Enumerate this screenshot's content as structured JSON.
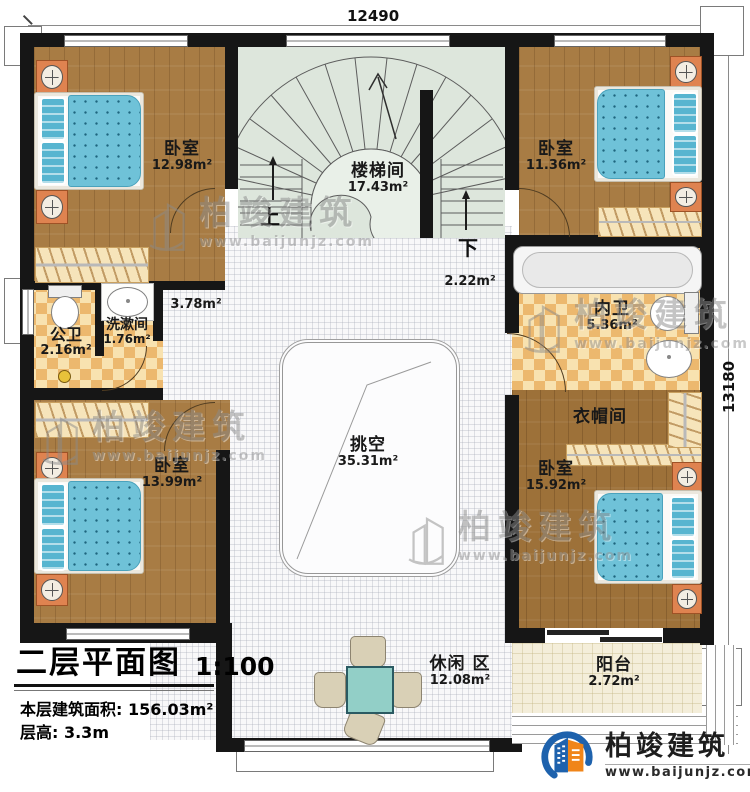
{
  "dimensions": {
    "width_label": "12490",
    "height_label": "13180"
  },
  "stairs": {
    "up": "上",
    "down": "下"
  },
  "rooms": {
    "bedroom_top_left": {
      "name": "卧室",
      "area": "12.98m²"
    },
    "stairwell": {
      "name": "楼梯间",
      "area": "17.43m²"
    },
    "bedroom_top_right": {
      "name": "卧室",
      "area": "11.36m²"
    },
    "hall_left": {
      "area": "3.78m²"
    },
    "hall_right": {
      "area": "2.22m²"
    },
    "public_bathroom": {
      "name": "公卫",
      "area": "2.16m²"
    },
    "washroom": {
      "name": "洗漱间",
      "area": "1.76m²"
    },
    "inner_bathroom": {
      "name": "内卫",
      "area": "5.36m²"
    },
    "cloakroom": {
      "name": "衣帽间"
    },
    "bedroom_bottom_left": {
      "name": "卧室",
      "area": "13.99m²"
    },
    "void": {
      "name": "挑空",
      "area": "35.31m²"
    },
    "bedroom_bottom_right": {
      "name": "卧室",
      "area": "15.92m²"
    },
    "leisure": {
      "name": "休闲 区",
      "area": "12.08m²"
    },
    "balcony": {
      "name": "阳台",
      "area": "2.72m²"
    }
  },
  "title_block": {
    "title": "二层平面图",
    "scale": "1:100",
    "floor_area": "本层建筑面积: 156.03m²",
    "floor_height": "层高: 3.3m"
  },
  "brand": {
    "name": "柏竣建筑",
    "website": "www.baijunjz.com"
  },
  "watermark": {
    "name": "柏竣建筑",
    "website": "www.baijunjz.com"
  },
  "colors": {
    "wall": "#161616",
    "wood": "#a87c44",
    "mattress": "#6fc2d8",
    "stair": "#dde6dc",
    "checker_dark": "#ecb86e",
    "brand_blue": "#1e62ad",
    "brand_orange": "#f08519"
  }
}
